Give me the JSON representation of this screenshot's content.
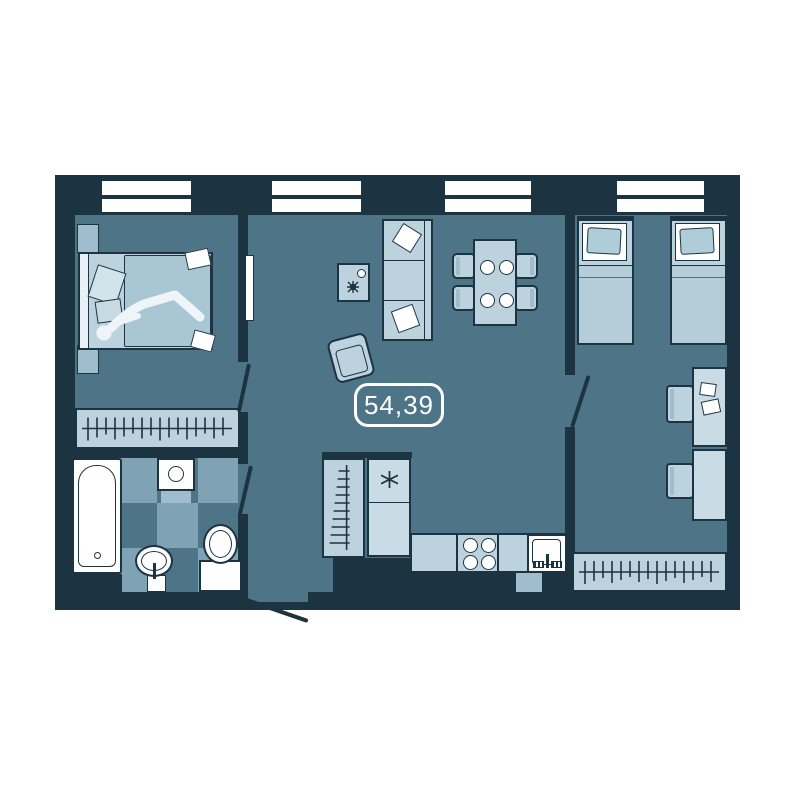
{
  "floorplan": {
    "area_label": "54,39"
  },
  "colors": {
    "wall": "#1c3442",
    "floor": "#4e7488",
    "furniture_light": "#bcd3de",
    "furniture_mid": "#9fbdcd",
    "furniture_pale": "#c9dbe4",
    "tile_light": "#7fa3b5",
    "white": "#ffffff",
    "background": "#ffffff"
  }
}
